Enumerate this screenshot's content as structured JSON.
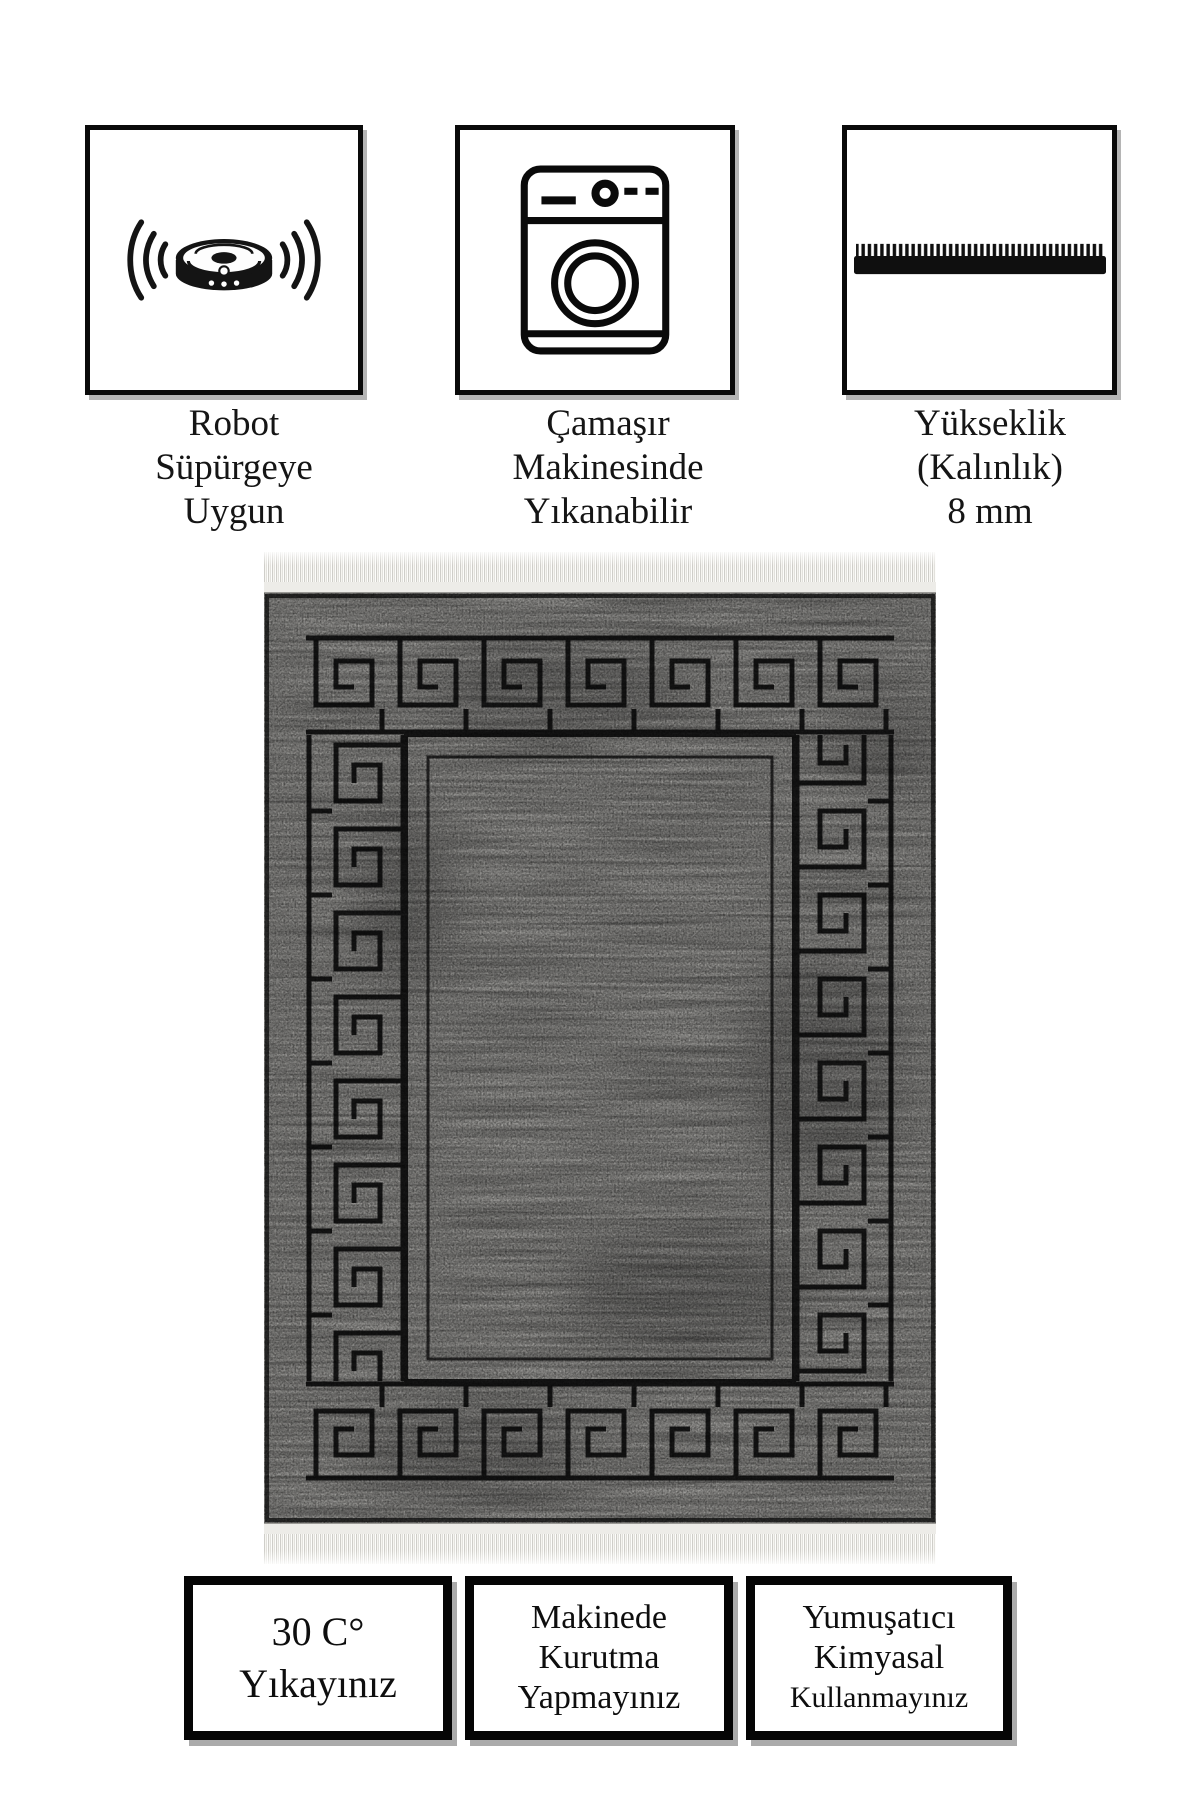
{
  "page": {
    "background_color": "#ffffff"
  },
  "top_features": [
    {
      "icon": "robot-vacuum-icon",
      "caption_lines": [
        "Robot",
        "Süpürgeye",
        "Uygun"
      ]
    },
    {
      "icon": "washing-machine-icon",
      "caption_lines": [
        "Çamaşır",
        "Makinesinde",
        "Yıkanabilir"
      ]
    },
    {
      "icon": "pile-height-icon",
      "caption_lines": [
        "Yükseklik",
        "(Kalınlık)",
        "8 mm"
      ]
    }
  ],
  "rug": {
    "pattern": "greek-key meander border on distressed gray field, white fringe top and bottom",
    "field_color": "#a5a4a1",
    "pattern_line_color": "#1c1c1c",
    "fringe_color": "#f4f3ef"
  },
  "care_boxes": [
    {
      "lines": [
        "30 C°",
        "Yıkayınız"
      ]
    },
    {
      "lines": [
        "Makinede",
        "Kurutma",
        "Yapmayınız"
      ]
    },
    {
      "lines": [
        "Yumuşatıcı",
        "Kimyasal",
        "Kullanmayınız"
      ]
    }
  ]
}
